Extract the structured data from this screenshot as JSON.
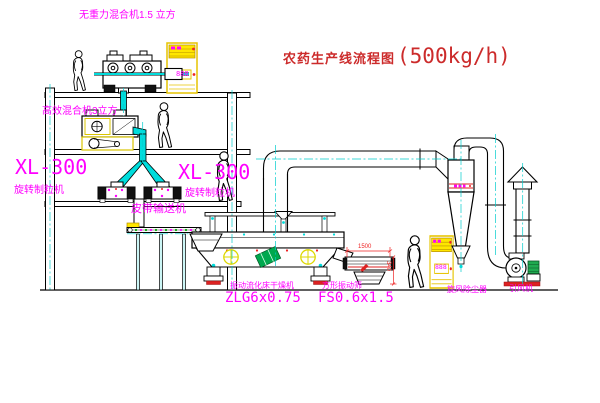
{
  "title": {
    "name": "农药生产线流程图",
    "capacity": "(500kg/h)"
  },
  "labels": {
    "gravity_free_mixer": "无重力混合机1.5 立方",
    "high_efficiency_mixer": "高效混合机3立方",
    "granulator_model_left": "XL-300",
    "granulator_name_left": "旋转制粒机",
    "granulator_model_right": "XL-300",
    "granulator_name_right": "旋转制粒机",
    "belt_conveyor": "皮带输送机",
    "dryer_name": "振动流化床干燥机",
    "dryer_model": "ZLG6x0.75",
    "screen_name": "方形振动筛",
    "screen_model": "FS0.6x1.5",
    "cyclone": "旋风除尘器",
    "fan": "引风机"
  },
  "dimensions": {
    "screen_length": "1500",
    "screen_height": "340"
  },
  "cabinets": {
    "top_display": "888",
    "bottom_display": "888"
  },
  "colors": {
    "line": "#000000",
    "pipe_cyan": "#00dcdc",
    "centerline_cyan": "#00cccc",
    "equipment_yellow": "#ffe600",
    "label_magenta": "#ff00ff",
    "title_red": "#cc2b2b",
    "dimension_red": "#ee2222",
    "motor_green": "#1faa50",
    "base_red": "#dd2222"
  }
}
